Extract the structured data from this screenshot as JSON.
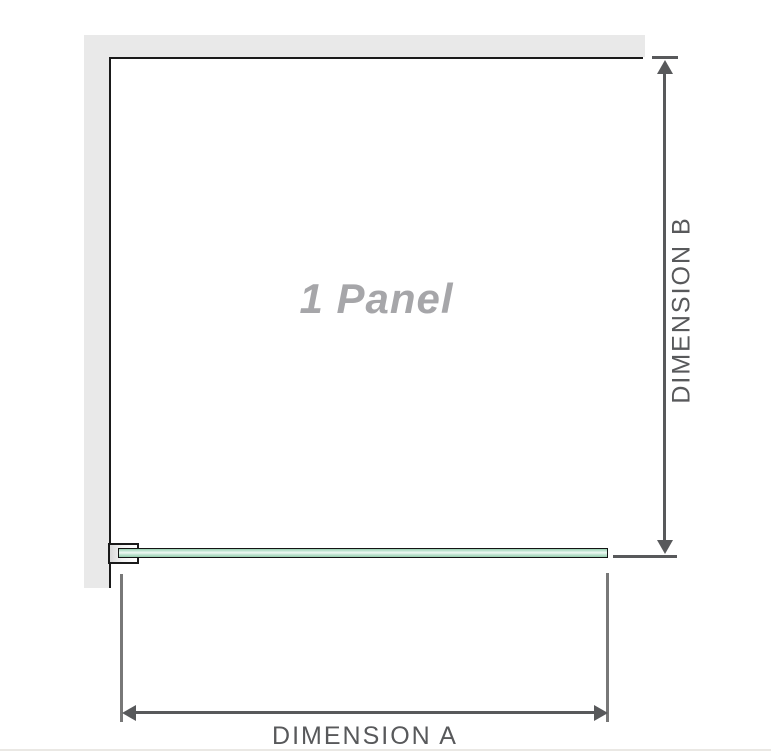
{
  "diagram": {
    "title": "1 Panel shower screen diagram",
    "panel_label": "1 Panel",
    "dimension_a_label": "DIMENSION A",
    "dimension_b_label": "DIMENSION B",
    "colors": {
      "wall": "#e9e9e9",
      "outline": "#1a1a1a",
      "dimension": "#58595b",
      "ext": "#787878",
      "panel_text": "#a6a6a9",
      "glass_light": "#f0f9f4",
      "glass_mid": "#cdebdc",
      "glass_dark": "#94cead",
      "bottom_rule": "#eae8e4"
    }
  }
}
